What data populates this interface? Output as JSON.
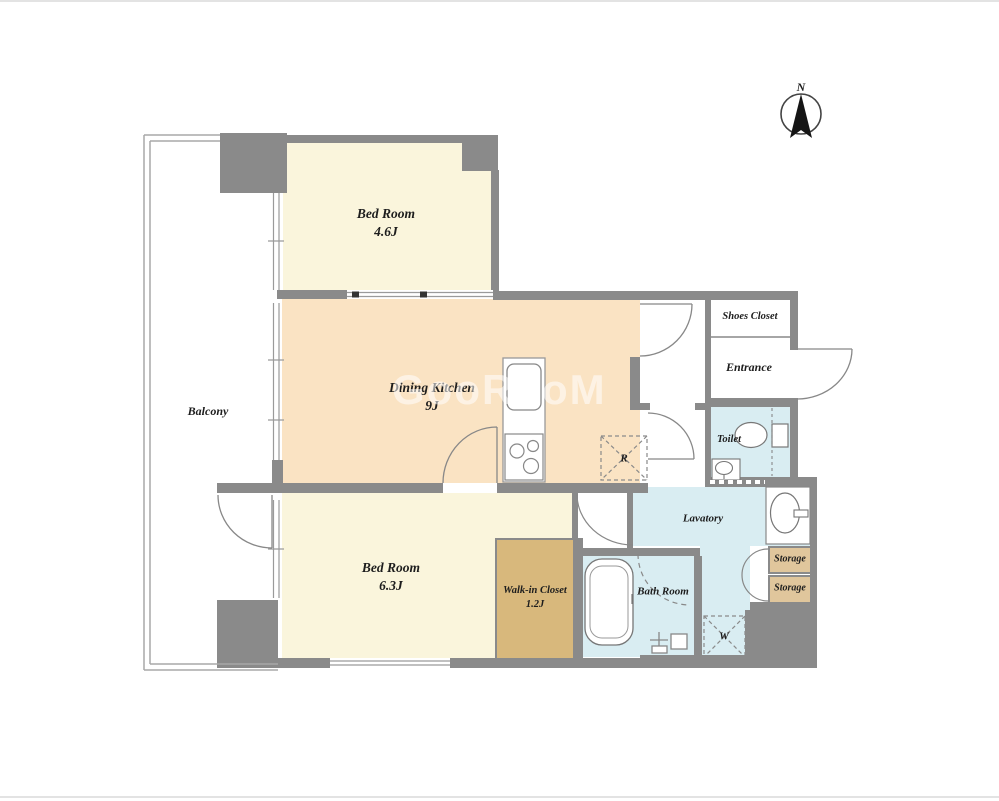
{
  "meta": {
    "title": "Apartment floor plan",
    "compass_label": "N",
    "watermark": "GooRooM"
  },
  "colors": {
    "wall": "#8a8a8a",
    "cream": "#faf5dc",
    "peach": "#fae3c3",
    "blue": "#d9edf2",
    "tan": "#d8b87c",
    "tan_light": "#e0c69c",
    "line": "#999999",
    "text": "#1d1d1d"
  },
  "rooms": {
    "bedroom_top": {
      "name": "Bed Room",
      "size": "4.6J"
    },
    "dining_kitchen": {
      "name": "Dining Kitchen",
      "size": "9J"
    },
    "bedroom_bottom": {
      "name": "Bed Room",
      "size": "6.3J"
    },
    "walk_in_closet": {
      "name": "Walk-in Closet",
      "size": "1.2J"
    },
    "balcony": {
      "name": "Balcony"
    },
    "shoes_closet": {
      "name": "Shoes Closet"
    },
    "entrance": {
      "name": "Entrance"
    },
    "toilet": {
      "name": "Toilet"
    },
    "lavatory": {
      "name": "Lavatory"
    },
    "bath_room": {
      "name": "Bath Room"
    },
    "storage_upper": {
      "name": "Storage"
    },
    "storage_lower": {
      "name": "Storage"
    }
  },
  "fixtures": {
    "refrigerator": "R",
    "washer": "W"
  }
}
